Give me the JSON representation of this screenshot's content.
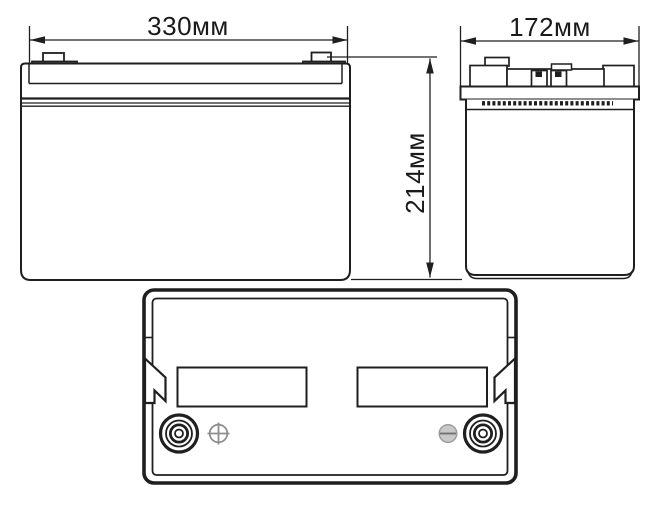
{
  "drawing": {
    "dimensions": {
      "width": {
        "label": "330мм"
      },
      "depth": {
        "label": "172мм"
      },
      "height": {
        "label": "214мм"
      }
    },
    "icons": {
      "positive_marker": "plus-in-circle-icon",
      "negative_marker": "minus-in-circle-icon"
    },
    "colors": {
      "line": "#1f1f1f",
      "background": "#ffffff",
      "marker_gray": "#8f8f8f",
      "minus_fill": "#c8c8c8",
      "minus_line": "#6e6e6e"
    }
  }
}
